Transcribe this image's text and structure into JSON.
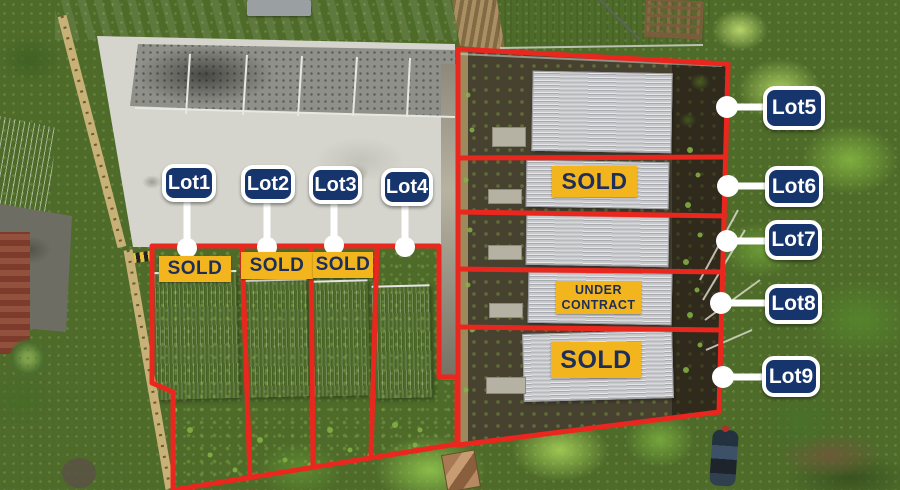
{
  "canvas": {
    "width": 900,
    "height": 490,
    "description": "Aerial drone photo of a townhouse development with nine outlined lots, callout labels and sale-status badges"
  },
  "colors": {
    "label_navy": "#16356d",
    "label_border": "#ffffff",
    "badge_yellow": "#f2b51e",
    "badge_text_navy": "#1e2e5a",
    "boundary_red": "#ea271e",
    "connector_white": "#ffffff"
  },
  "lots": [
    {
      "name": "Lot1",
      "badge": "SOLD"
    },
    {
      "name": "Lot2",
      "badge": "SOLD"
    },
    {
      "name": "Lot3",
      "badge": "SOLD"
    },
    {
      "name": "Lot4",
      "badge": null
    },
    {
      "name": "Lot5",
      "badge": null
    },
    {
      "name": "Lot6",
      "badge": "SOLD"
    },
    {
      "name": "Lot7",
      "badge": null
    },
    {
      "name": "Lot8",
      "badge": "UNDER CONTRACT"
    },
    {
      "name": "Lot9",
      "badge": "SOLD"
    }
  ]
}
